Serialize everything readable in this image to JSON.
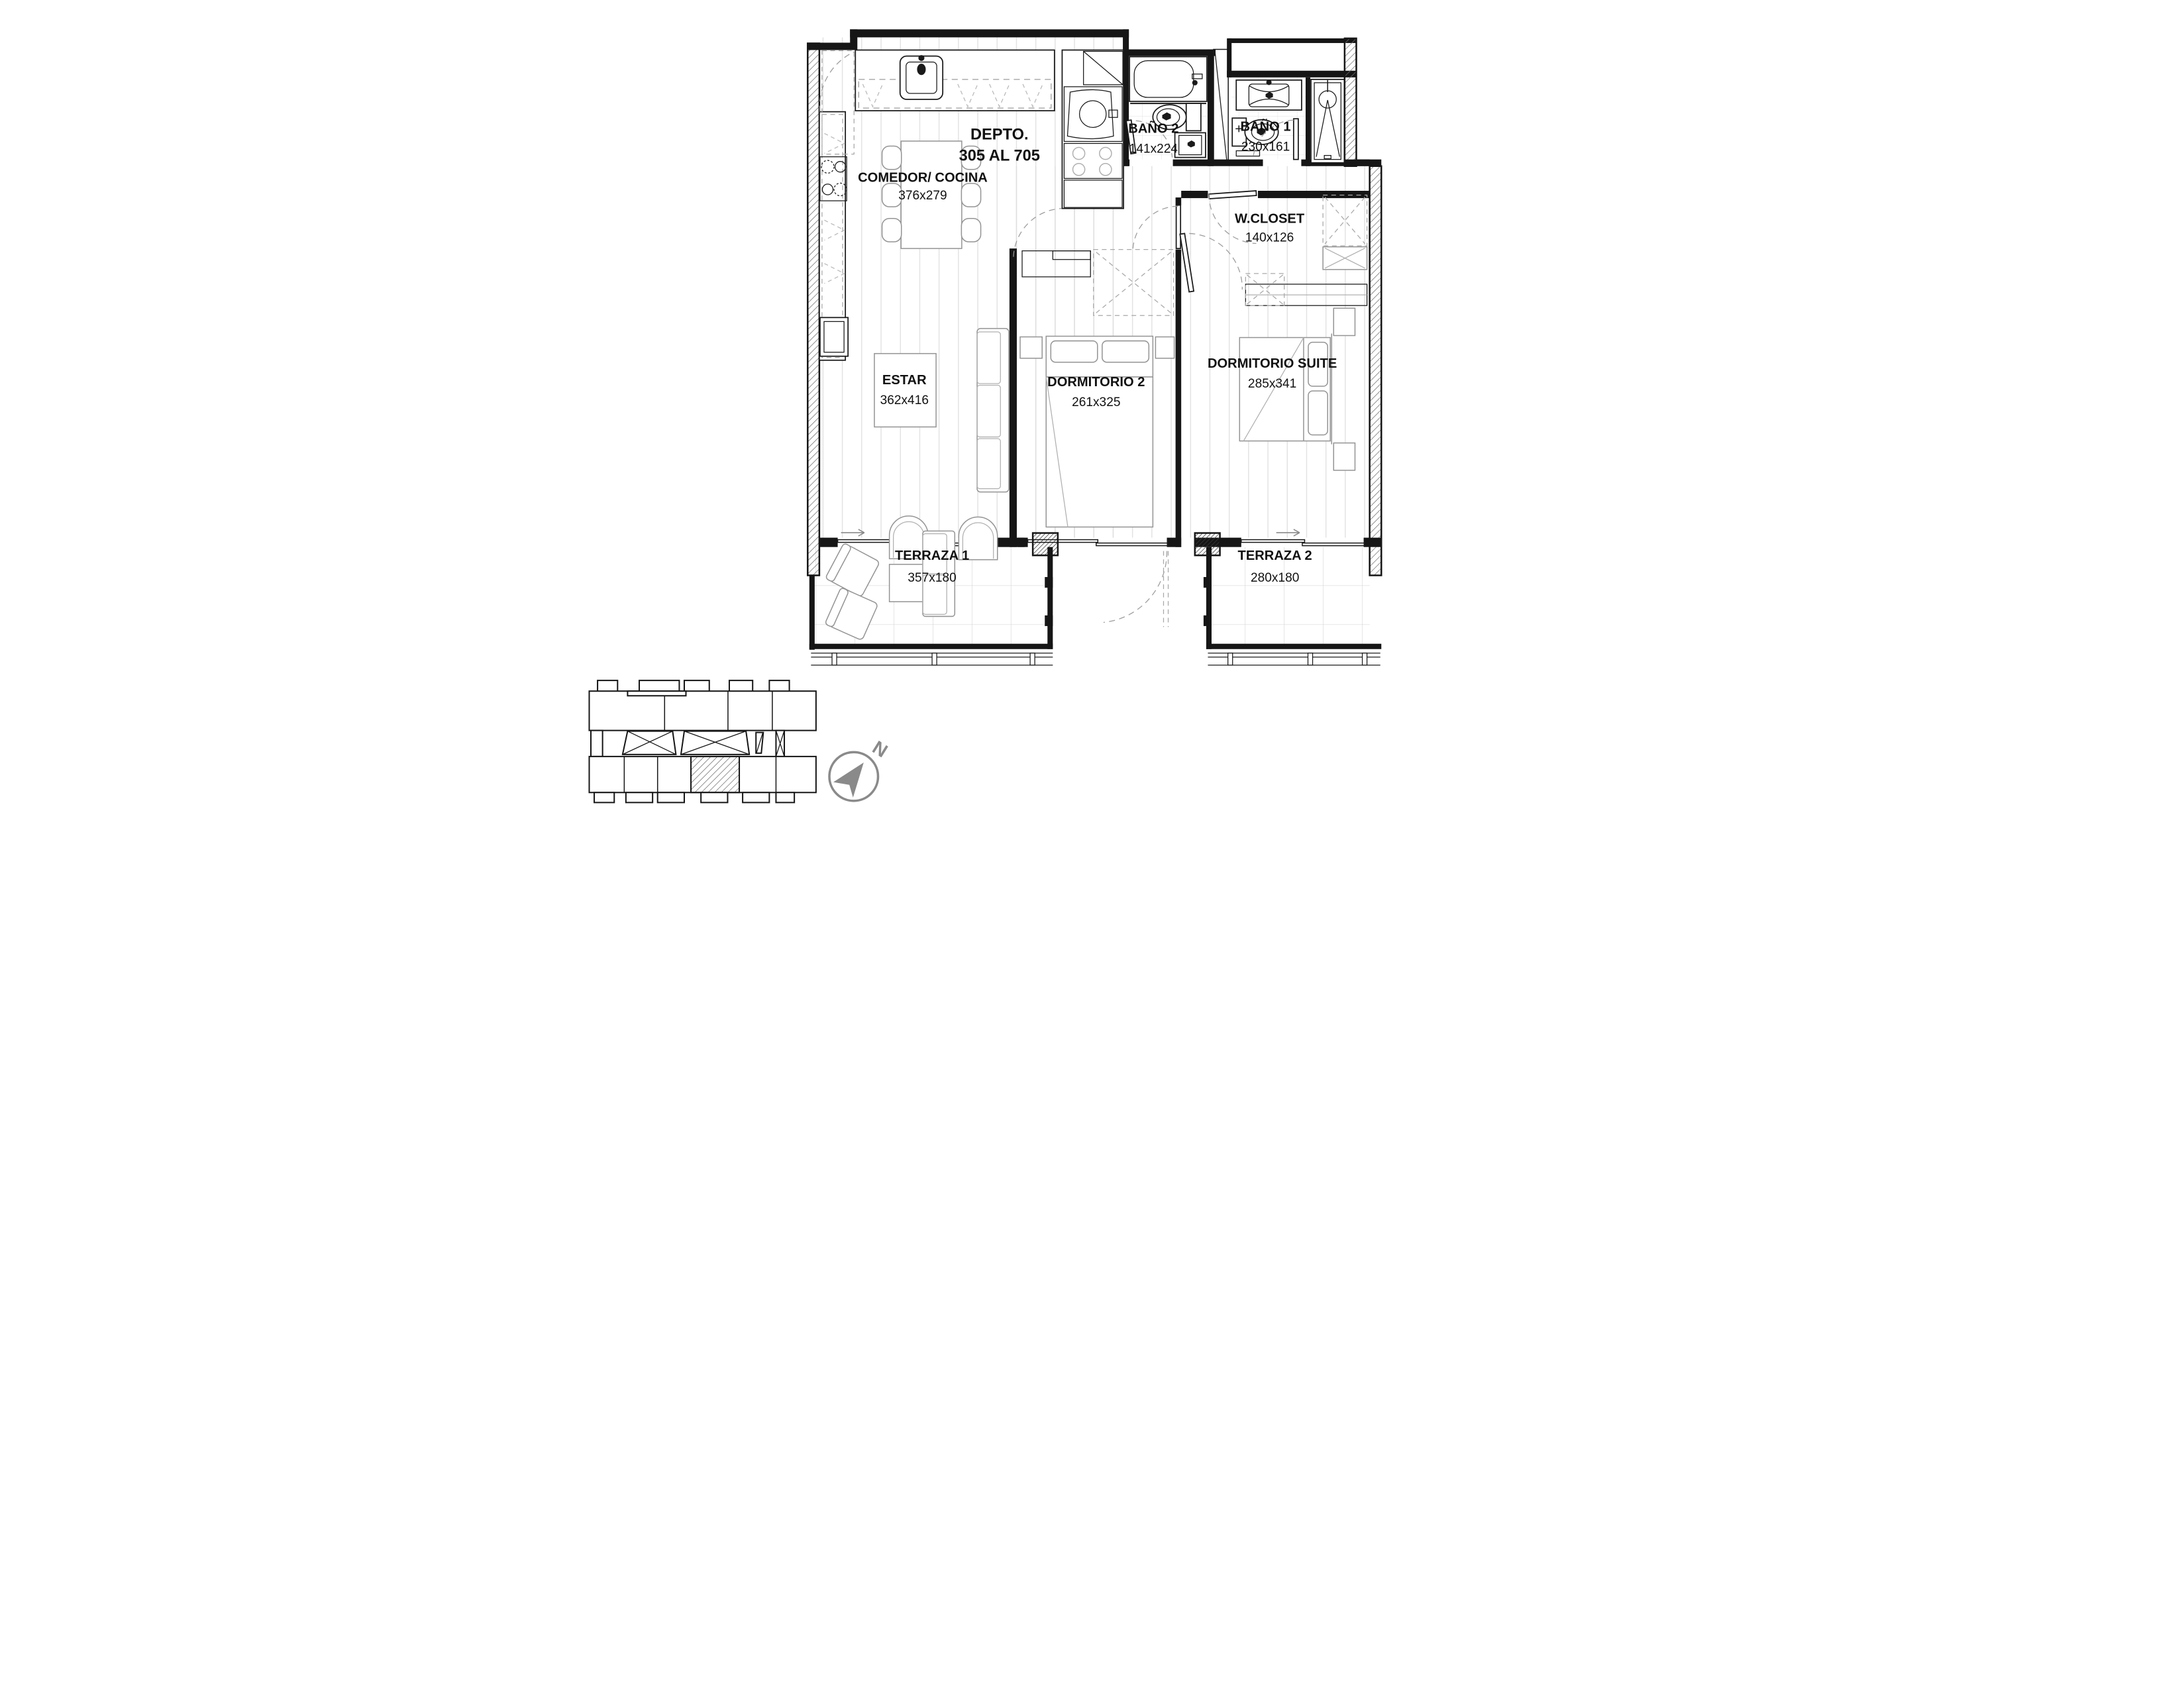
{
  "plan": {
    "title": {
      "line1": "DEPTO.",
      "line2": "305 AL 705"
    },
    "rooms": [
      {
        "id": "comedor",
        "name": "COMEDOR/ COCINA",
        "dims": "376x279"
      },
      {
        "id": "estar",
        "name": "ESTAR",
        "dims": "362x416"
      },
      {
        "id": "dormitorio2",
        "name": "DORMITORIO 2",
        "dims": "261x325"
      },
      {
        "id": "suite",
        "name": "DORMITORIO SUITE",
        "dims": "285x341"
      },
      {
        "id": "bano2",
        "name": "BAÑO 2",
        "dims": "141x224"
      },
      {
        "id": "bano1",
        "name": "BAÑO 1",
        "dims": "230x161"
      },
      {
        "id": "wcloset",
        "name": "W.CLOSET",
        "dims": "140x126"
      },
      {
        "id": "terraza1",
        "name": "TERRAZA 1",
        "dims": "357x180"
      },
      {
        "id": "terraza2",
        "name": "TERRAZA 2",
        "dims": "280x180"
      }
    ],
    "compass": {
      "label": "N"
    },
    "colors": {
      "ink": "#161616",
      "furniture_gray": "#949494",
      "floor_line": "#dedede",
      "tile_line": "#d6d6d6",
      "compass_gray": "#8a8a8a",
      "background": "#ffffff"
    }
  }
}
